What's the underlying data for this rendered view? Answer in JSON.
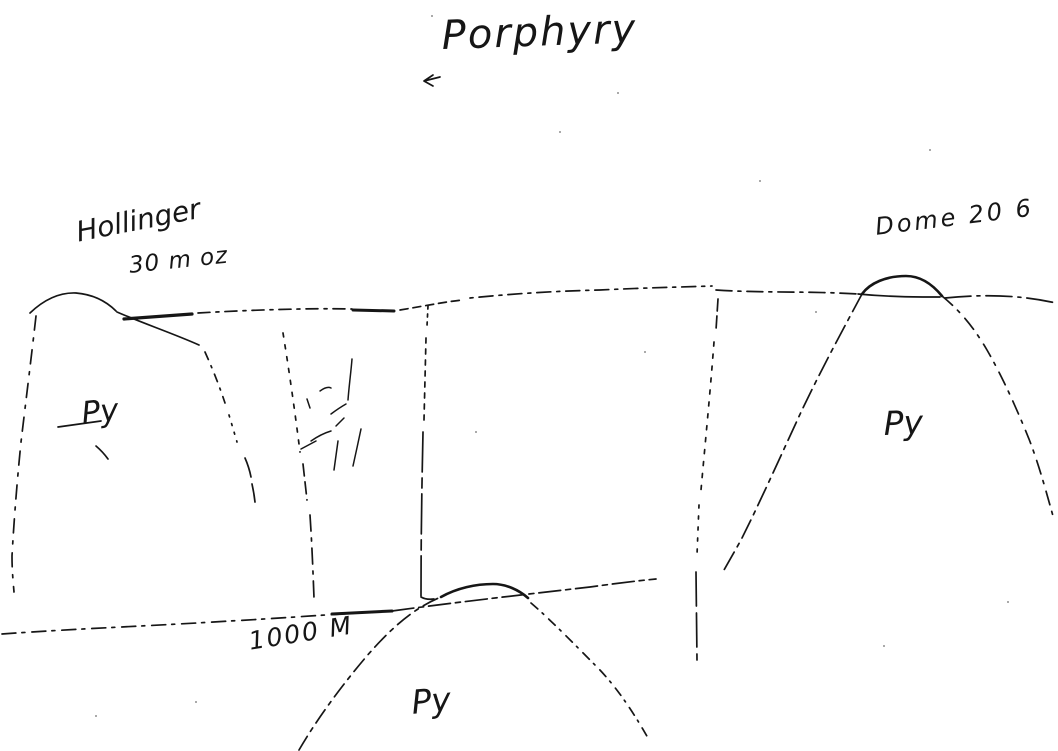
{
  "page": {
    "background_color": "#ffffff",
    "ink_color": "#161616"
  },
  "sketch": {
    "title": "Porphyry",
    "annotations": {
      "deposit_left_name": "Hollinger",
      "deposit_left_value": "30 m oz",
      "deposit_right": "Dome 20 6",
      "scale": "1000 M"
    },
    "regions": {
      "py_left": "Py",
      "py_right": "Py",
      "py_bottom": "Py"
    }
  }
}
